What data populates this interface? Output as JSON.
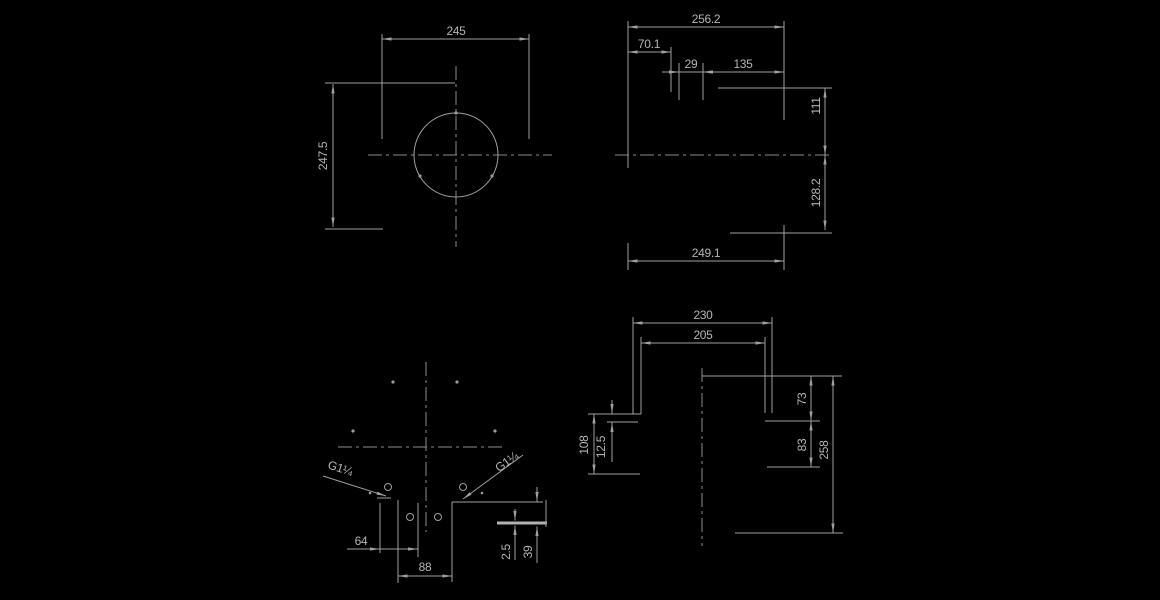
{
  "drawing": {
    "type": "engineering-technical-drawing",
    "background_color": "#000000",
    "line_color": "#a0a0a0",
    "text_color": "#b5b5b5"
  },
  "dimensions": {
    "d245": "245",
    "d247_5": "247.5",
    "d256_2": "256.2",
    "d70_1": "70.1",
    "d29": "29",
    "d135": "135",
    "d111": "111",
    "d128_2": "128.2",
    "d249_1": "249.1",
    "d230": "230",
    "d205": "205",
    "d12_5": "12.5",
    "d108": "108",
    "d73": "73",
    "d83": "83",
    "d258": "258",
    "d64": "64",
    "d88": "88",
    "d2_5": "2.5",
    "d39": "39"
  },
  "labels": {
    "thread_left": "G1¼",
    "thread_right": "G1¼"
  }
}
